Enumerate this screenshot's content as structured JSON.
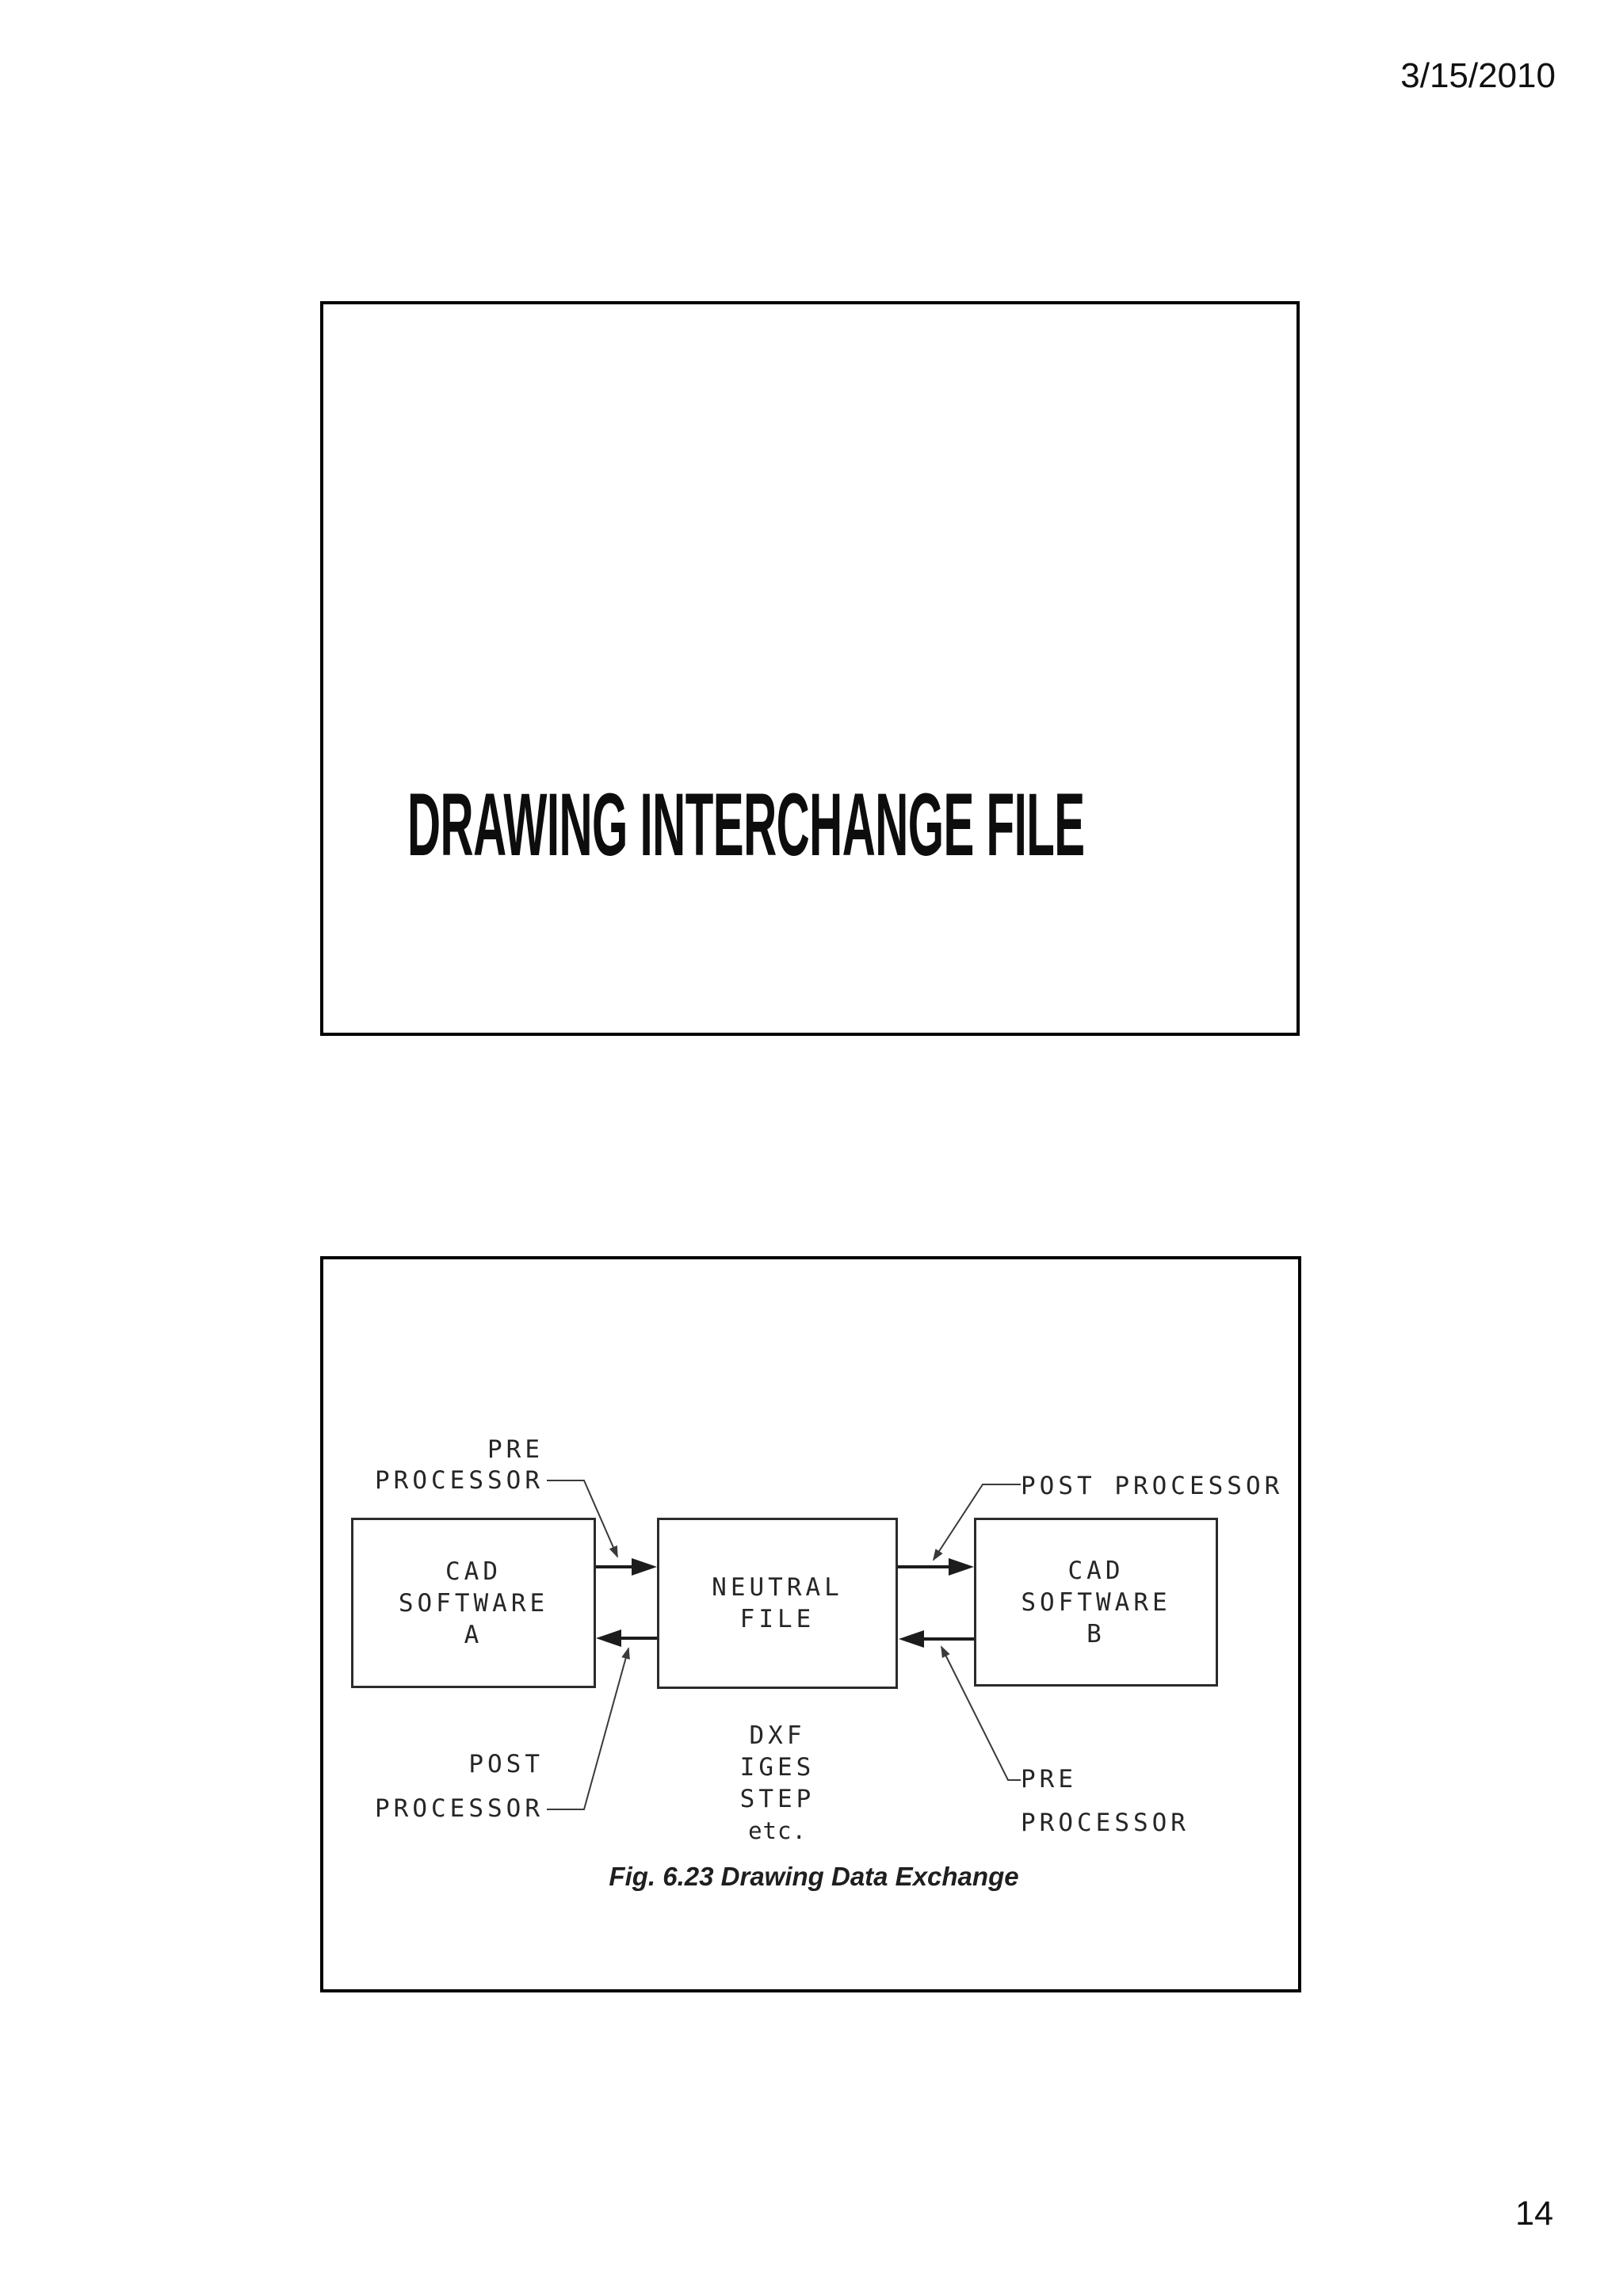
{
  "page": {
    "date": "3/15/2010",
    "number": "14"
  },
  "slide1": {
    "title": "DRAWING INTERCHANGE FILE"
  },
  "slide2": {
    "diagram": {
      "box_a": {
        "lines": [
          "CAD",
          "SOFTWARE",
          "A"
        ]
      },
      "box_neutral": {
        "lines": [
          "NEUTRAL",
          "FILE"
        ]
      },
      "box_b": {
        "lines": [
          "CAD",
          "SOFTWARE",
          "B"
        ]
      },
      "label_pre_top": {
        "lines": [
          "PRE",
          "PROCESSOR"
        ]
      },
      "label_post_top": {
        "lines": [
          "POST PROCESSOR"
        ]
      },
      "label_post_bottom": {
        "lines": [
          "POST",
          "PROCESSOR"
        ]
      },
      "label_pre_bottom": {
        "lines": [
          "PRE",
          "PROCESSOR"
        ]
      },
      "neutral_formats": {
        "lines": [
          "DXF",
          "IGES",
          "STEP",
          "etc."
        ]
      },
      "caption": "Fig. 6.23 Drawing Data Exchange"
    }
  },
  "colors": {
    "ink": "#1c1c1c",
    "diagram_stroke": "#2b2b2b",
    "slide_border": "#000000",
    "background": "#ffffff"
  }
}
